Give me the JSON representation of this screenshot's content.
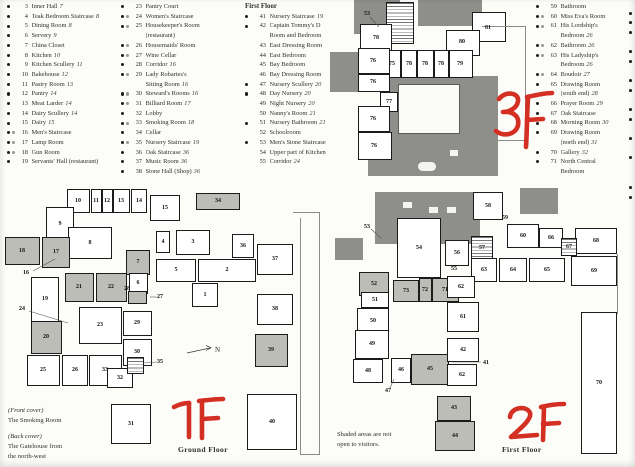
{
  "colors": {
    "red_annotation": "#d32f23",
    "shaded_room": "#bdbdb7",
    "roof": "#8e8e8b",
    "wall": "#1b1b1b"
  },
  "legend": {
    "columns": [
      {
        "heading": null,
        "items": [
          {
            "b": "●",
            "n": "3",
            "label": "Inner Hall",
            "pg": "7"
          },
          {
            "b": "●",
            "n": "4",
            "label": "Teak Bedroom Staircase",
            "pg": "8"
          },
          {
            "b": "●",
            "n": "5",
            "label": "Dining Room",
            "pg": "8"
          },
          {
            "b": "●",
            "n": "6",
            "label": "Servery",
            "pg": "9"
          },
          {
            "b": "●",
            "n": "7",
            "label": "China Closet"
          },
          {
            "b": "●",
            "n": "8",
            "label": "Kitchen",
            "pg": "10"
          },
          {
            "b": "●",
            "n": "9",
            "label": "Kitchen Scullery",
            "pg": "11"
          },
          {
            "b": "●",
            "n": "10",
            "label": "Bakehouse",
            "pg": "12"
          },
          {
            "b": "●",
            "n": "11",
            "label": "Pastry Room",
            "pg": "13"
          },
          {
            "b": "●",
            "n": "12",
            "label": "Pantry",
            "pg": "14"
          },
          {
            "b": "●",
            "n": "13",
            "label": "Meat Larder",
            "pg": "14"
          },
          {
            "b": "●",
            "n": "14",
            "label": "Dairy Scullery",
            "pg": "14"
          },
          {
            "b": "●",
            "n": "15",
            "label": "Dairy",
            "pg": "15"
          },
          {
            "b": "●○",
            "n": "16",
            "label": "Men's Staircase"
          },
          {
            "b": "●○",
            "n": "17",
            "label": "Lamp Room"
          },
          {
            "b": "●○",
            "n": "18",
            "label": "Gun Room"
          },
          {
            "b": "●",
            "n": "19",
            "label": "Servants' Hall (restaurant)"
          }
        ]
      },
      {
        "heading": null,
        "items": [
          {
            "b": "●",
            "n": "23",
            "label": "Pantry Court"
          },
          {
            "b": "●○",
            "n": "24",
            "label": "Women's Staircase"
          },
          {
            "b": "●○",
            "n": "25",
            "label": "Housekeeper's Room",
            "label2": "(restaurant)"
          },
          {
            "b": "●○",
            "n": "26",
            "label": "Housemaids' Room"
          },
          {
            "b": "●○",
            "n": "27",
            "label": "Wine Cellar"
          },
          {
            "b": "●",
            "n": "28",
            "label": "Corridor",
            "pg": "16"
          },
          {
            "b": "●○",
            "n": "29",
            "label": "Lady Robartes's",
            "label2": "Sitting Room",
            "pg2": "16"
          },
          {
            "b": "●○",
            "n": "30",
            "label": "Steward's Rooms",
            "pg": "16"
          },
          {
            "b": "●○",
            "n": "31",
            "label": "Billiard Room",
            "pg": "17"
          },
          {
            "b": "●",
            "n": "32",
            "label": "Lobby"
          },
          {
            "b": "●○",
            "n": "33",
            "label": "Smoking Room",
            "pg": "18"
          },
          {
            "b": "●",
            "n": "34",
            "label": "Cellar"
          },
          {
            "b": "●○",
            "n": "35",
            "label": "Nursery Staircase",
            "pg": "19"
          },
          {
            "b": "●",
            "n": "36",
            "label": "Oak Staircase",
            "pg": "36"
          },
          {
            "b": "●",
            "n": "37",
            "label": "Music Room",
            "pg": "36"
          },
          {
            "b": "●",
            "n": "38",
            "label": "Stone Hall (Shop)",
            "pg": "36"
          }
        ]
      },
      {
        "heading": "First Floor",
        "items": [
          {
            "b": "●",
            "n": "41",
            "label": "Nursery Staircase",
            "pg": "19"
          },
          {
            "b": "●",
            "n": "42",
            "label": "Captain Tommy's D",
            "label2": "Room and Bedroom"
          },
          {
            "b": "",
            "n": "43",
            "label": "East Dressing Room"
          },
          {
            "b": "",
            "n": "44",
            "label": "East Bedroom"
          },
          {
            "b": "",
            "n": "45",
            "label": "Bay Bedroom"
          },
          {
            "b": "",
            "n": "46",
            "label": "Bay Dressing Room"
          },
          {
            "b": "●",
            "n": "47",
            "label": "Nursery Scullery",
            "pg": "20"
          },
          {
            "b": "●",
            "n": "48",
            "label": "Day Nursery",
            "pg": "20"
          },
          {
            "b": "",
            "n": "49",
            "label": "Night Nursery",
            "pg": "20"
          },
          {
            "b": "",
            "n": "50",
            "label": "Nanny's Room",
            "pg": "21"
          },
          {
            "b": "●",
            "n": "51",
            "label": "Nursery Bathroom",
            "pg": "21"
          },
          {
            "b": "",
            "n": "52",
            "label": "Schoolroom"
          },
          {
            "b": "●",
            "n": "53",
            "label": "Men's Stone Staircase"
          },
          {
            "b": "",
            "n": "54",
            "label": "Upper part of Kitchen"
          },
          {
            "b": "",
            "n": "55",
            "label": "Corridor",
            "pg": "24"
          }
        ]
      },
      {
        "heading": null,
        "items": [
          {
            "b": "●",
            "n": "59",
            "label": "Bathroom"
          },
          {
            "b": "●○",
            "n": "60",
            "label": "Miss Eva's Room"
          },
          {
            "b": "●○",
            "n": "61",
            "label": "His Lordship's",
            "label2": "Bedroom",
            "pg2": "26"
          },
          {
            "b": "●○",
            "n": "62",
            "label": "Bathroom",
            "pg": "26"
          },
          {
            "b": "●○",
            "n": "63",
            "label": "His Ladyship's",
            "label2": "Bedroom",
            "pg2": "26"
          },
          {
            "b": "●○",
            "n": "64",
            "label": "Boudoir",
            "pg": "27"
          },
          {
            "b": "●",
            "n": "65",
            "label": "Drawing Room",
            "label2": "(south end)",
            "pg2": "28"
          },
          {
            "b": "●",
            "n": "66",
            "label": "Prayer Room",
            "pg": "29"
          },
          {
            "b": "●",
            "n": "67",
            "label": "Oak Staircase"
          },
          {
            "b": "●",
            "n": "68",
            "label": "Morning Room",
            "pg": "30"
          },
          {
            "b": "●",
            "n": "69",
            "label": "Drawing Room",
            "label2": "(north end)",
            "pg2": "31"
          },
          {
            "b": "●",
            "n": "70",
            "label": "Gallery",
            "pg": "32"
          },
          {
            "b": "●",
            "n": "71",
            "label": "North Central",
            "label2": "Bedroom"
          }
        ]
      }
    ]
  },
  "plans": {
    "second_floor": {
      "annotation": "3F",
      "rooms": [
        {
          "n": "53",
          "x": 37,
          "y": 14
        },
        {
          "n": "78",
          "x": 46,
          "y": 38
        },
        {
          "n": "81",
          "x": 158,
          "y": 28
        },
        {
          "n": "80",
          "x": 132,
          "y": 42
        },
        {
          "n": "75",
          "x": 62,
          "y": 64
        },
        {
          "n": "78",
          "x": 79,
          "y": 64
        },
        {
          "n": "78",
          "x": 95,
          "y": 64
        },
        {
          "n": "78",
          "x": 111,
          "y": 64
        },
        {
          "n": "79",
          "x": 130,
          "y": 64
        },
        {
          "n": "76",
          "x": 43,
          "y": 61
        },
        {
          "n": "76",
          "x": 43,
          "y": 82
        },
        {
          "n": "77",
          "x": 59,
          "y": 102
        },
        {
          "n": "76",
          "x": 43,
          "y": 119
        },
        {
          "n": "76",
          "x": 44,
          "y": 146
        }
      ]
    },
    "ground_floor": {
      "annotation": "1F",
      "caption": "Ground Floor",
      "rooms": [
        {
          "n": "10",
          "x": 78,
          "y": 21
        },
        {
          "n": "11",
          "x": 96,
          "y": 21
        },
        {
          "n": "12",
          "x": 107,
          "y": 21
        },
        {
          "n": "13",
          "x": 121,
          "y": 21
        },
        {
          "n": "14",
          "x": 139,
          "y": 21
        },
        {
          "n": "15",
          "x": 165,
          "y": 28
        },
        {
          "n": "9",
          "x": 60,
          "y": 44
        },
        {
          "n": "8",
          "x": 90,
          "y": 63
        },
        {
          "n": "34",
          "x": 218,
          "y": 21
        },
        {
          "n": "18",
          "x": 22,
          "y": 71
        },
        {
          "n": "17",
          "x": 56,
          "y": 72
        },
        {
          "n": "16",
          "x": 26,
          "y": 93
        },
        {
          "n": "7",
          "x": 138,
          "y": 82
        },
        {
          "n": "4",
          "x": 163,
          "y": 62
        },
        {
          "n": "3",
          "x": 193,
          "y": 62
        },
        {
          "n": "36",
          "x": 243,
          "y": 66
        },
        {
          "n": "37",
          "x": 275,
          "y": 79
        },
        {
          "n": "5",
          "x": 176,
          "y": 90
        },
        {
          "n": "2",
          "x": 227,
          "y": 90
        },
        {
          "n": "1",
          "x": 205,
          "y": 115
        },
        {
          "n": "21",
          "x": 79,
          "y": 107
        },
        {
          "n": "22",
          "x": 111,
          "y": 107
        },
        {
          "n": "28",
          "x": 127,
          "y": 109
        },
        {
          "n": "6",
          "x": 138,
          "y": 103
        },
        {
          "n": "27",
          "x": 160,
          "y": 117
        },
        {
          "n": "19",
          "x": 45,
          "y": 119
        },
        {
          "n": "24",
          "x": 22,
          "y": 129
        },
        {
          "n": "23",
          "x": 100,
          "y": 145
        },
        {
          "n": "29",
          "x": 137,
          "y": 143
        },
        {
          "n": "20",
          "x": 46,
          "y": 157
        },
        {
          "n": "30",
          "x": 137,
          "y": 172
        },
        {
          "n": "25",
          "x": 43,
          "y": 190
        },
        {
          "n": "26",
          "x": 75,
          "y": 190
        },
        {
          "n": "33",
          "x": 105,
          "y": 190
        },
        {
          "n": "32",
          "x": 120,
          "y": 198
        },
        {
          "n": "35",
          "x": 160,
          "y": 182
        },
        {
          "n": "31",
          "x": 131,
          "y": 244
        },
        {
          "n": "38",
          "x": 275,
          "y": 129
        },
        {
          "n": "39",
          "x": 271,
          "y": 170
        },
        {
          "n": "40",
          "x": 272,
          "y": 242
        }
      ]
    },
    "first_floor": {
      "annotation": "2F",
      "caption": "First Floor",
      "note_line1": "Shaded areas are not",
      "note_line2": "open to visitors.",
      "rooms": [
        {
          "n": "53",
          "x": 32,
          "y": 47
        },
        {
          "n": "54",
          "x": 84,
          "y": 68
        },
        {
          "n": "58",
          "x": 153,
          "y": 26
        },
        {
          "n": "59",
          "x": 170,
          "y": 38
        },
        {
          "n": "60",
          "x": 188,
          "y": 56
        },
        {
          "n": "66",
          "x": 216,
          "y": 58
        },
        {
          "n": "67",
          "x": 234,
          "y": 67
        },
        {
          "n": "68",
          "x": 261,
          "y": 61
        },
        {
          "n": "57",
          "x": 147,
          "y": 68
        },
        {
          "n": "56",
          "x": 122,
          "y": 73
        },
        {
          "n": "55",
          "x": 119,
          "y": 89
        },
        {
          "n": "63",
          "x": 149,
          "y": 90
        },
        {
          "n": "64",
          "x": 178,
          "y": 90
        },
        {
          "n": "65",
          "x": 212,
          "y": 90
        },
        {
          "n": "69",
          "x": 259,
          "y": 91
        },
        {
          "n": "52",
          "x": 39,
          "y": 104
        },
        {
          "n": "73",
          "x": 71,
          "y": 111
        },
        {
          "n": "72",
          "x": 90,
          "y": 110
        },
        {
          "n": "71",
          "x": 110,
          "y": 110
        },
        {
          "n": "62",
          "x": 126,
          "y": 107
        },
        {
          "n": "51",
          "x": 40,
          "y": 120
        },
        {
          "n": "50",
          "x": 38,
          "y": 141
        },
        {
          "n": "61",
          "x": 128,
          "y": 137
        },
        {
          "n": "49",
          "x": 37,
          "y": 164
        },
        {
          "n": "48",
          "x": 33,
          "y": 191
        },
        {
          "n": "46",
          "x": 66,
          "y": 190
        },
        {
          "n": "45",
          "x": 95,
          "y": 189
        },
        {
          "n": "42",
          "x": 128,
          "y": 170
        },
        {
          "n": "41",
          "x": 151,
          "y": 183
        },
        {
          "n": "62",
          "x": 127,
          "y": 195
        },
        {
          "n": "43",
          "x": 119,
          "y": 228
        },
        {
          "n": "44",
          "x": 120,
          "y": 256
        },
        {
          "n": "47",
          "x": 53,
          "y": 211
        },
        {
          "n": "70",
          "x": 264,
          "y": 203
        }
      ]
    }
  },
  "cover_notes": {
    "front_label": "(Front cover)",
    "front_value": "The Smoking Room",
    "back_label": "(Back cover)",
    "back_value_line1": "The Gatehouse from",
    "back_value_line2": "the north-west"
  },
  "compass": {
    "label": "N"
  },
  "page_edge": {
    "bullets_y": [
      12,
      21,
      31,
      50,
      60,
      79,
      89,
      108,
      118,
      137,
      156,
      186,
      196
    ]
  }
}
